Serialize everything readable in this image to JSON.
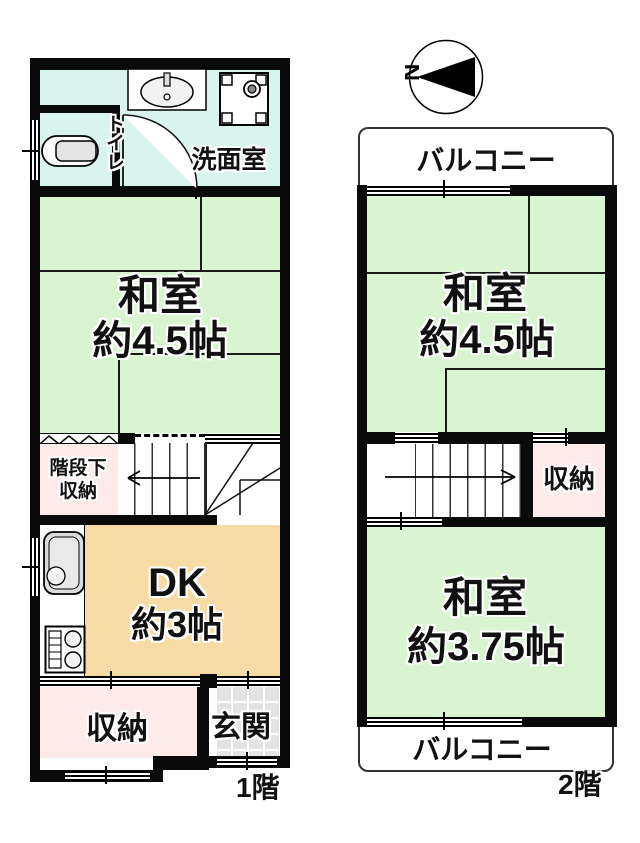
{
  "compass": {
    "north": "N"
  },
  "floor1": {
    "label": "1階",
    "washroom": "洗面室",
    "toilet": "トイレ",
    "washitsu_name": "和室",
    "washitsu_size": "約4.5帖",
    "understairs_line1": "階段下",
    "understairs_line2": "収納",
    "dk_name": "DK",
    "dk_size": "約3帖",
    "storage": "収納",
    "entrance": "玄関"
  },
  "floor2": {
    "label": "2階",
    "balcony_top": "バルコニー",
    "balcony_bottom": "バルコニー",
    "washitsu1_name": "和室",
    "washitsu1_size": "約4.5帖",
    "storage": "収納",
    "washitsu2_name": "和室",
    "washitsu2_size": "約3.75帖"
  },
  "colors": {
    "tatami_green": "#d8f4d0",
    "washroom_cyan": "#d9f3ef",
    "storage_pink": "#fcebea",
    "dk_tan": "#f6dba4",
    "tile_gray": "#e3e3e3",
    "wall_black": "#0a0a0a"
  }
}
